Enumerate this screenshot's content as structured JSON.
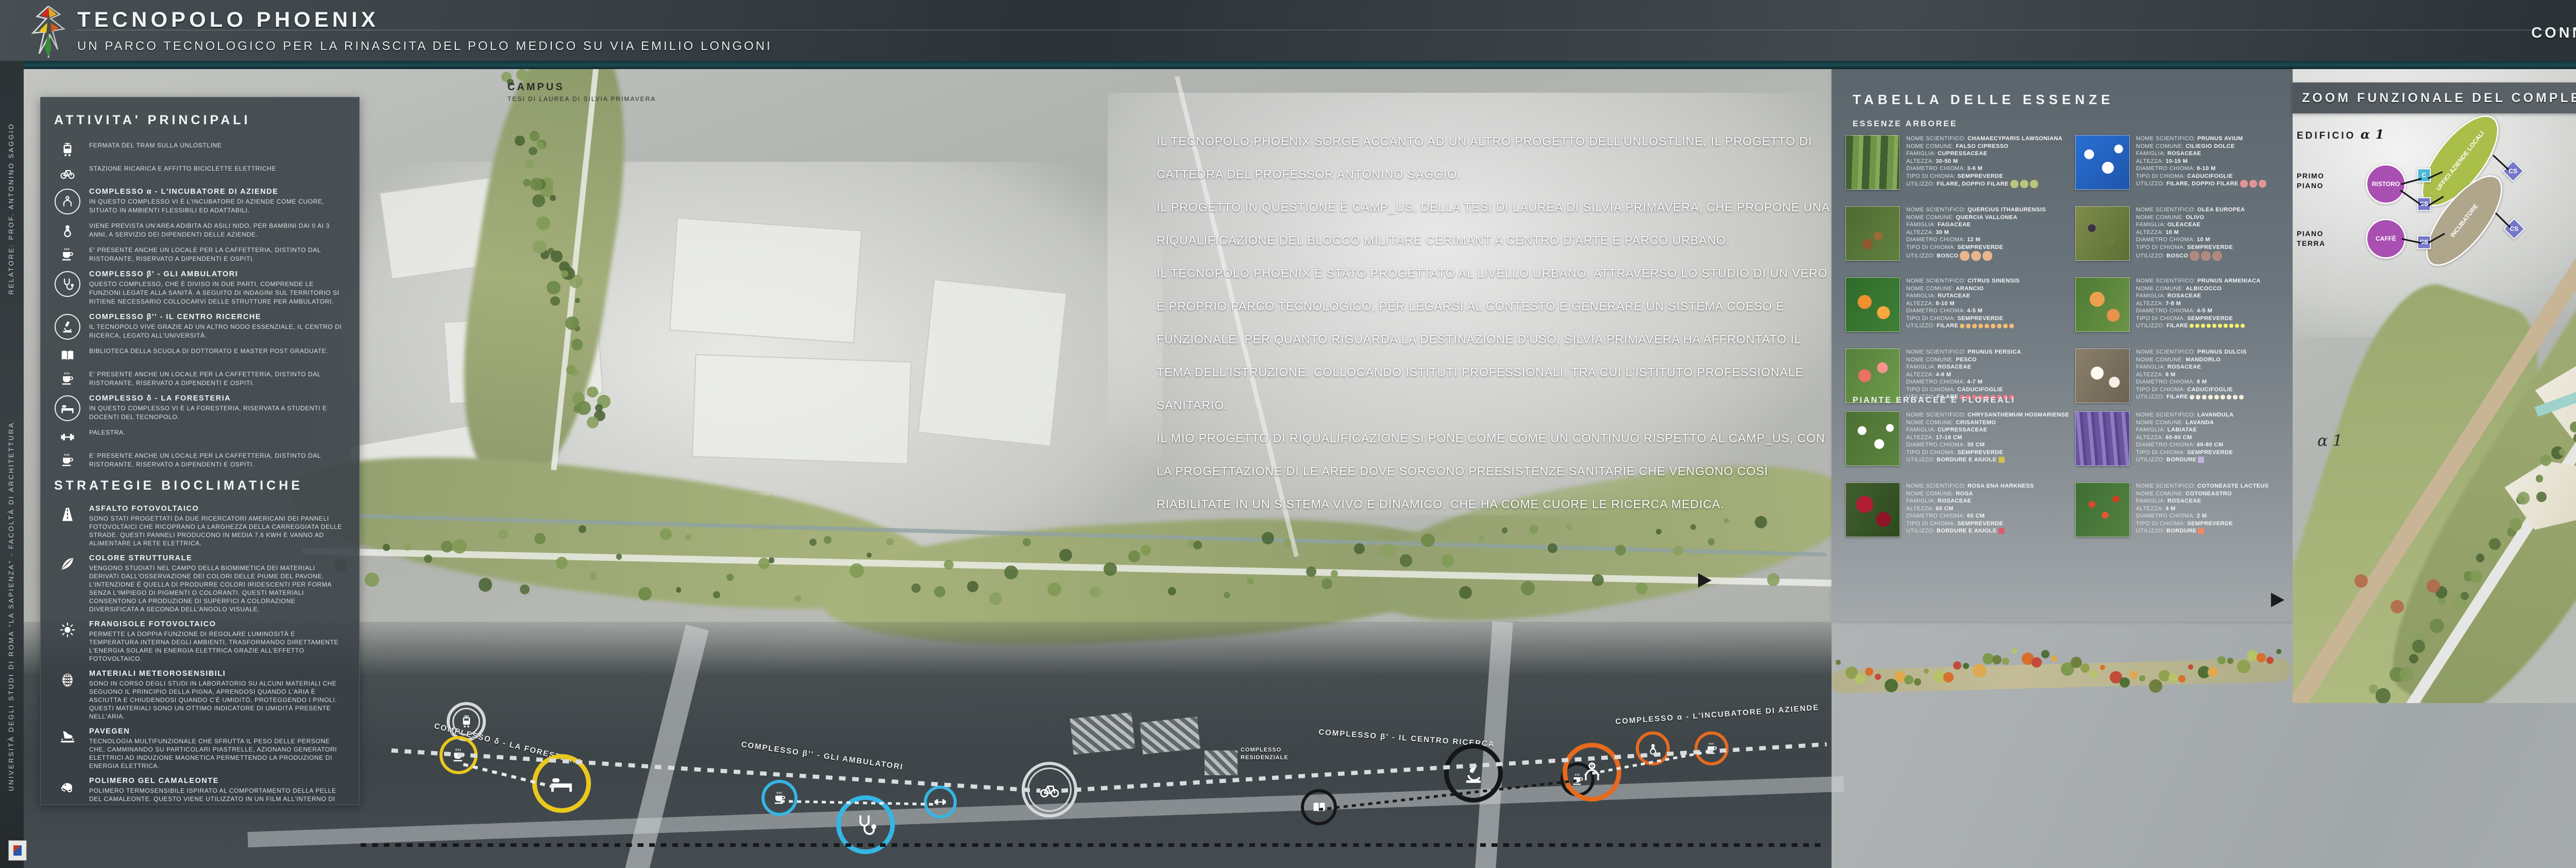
{
  "header": {
    "title": "TECNOPOLO PHOENIX",
    "subtitle": "UN PARCO TECNOLOGICO PER LA RINASCITA DEL POLO MEDICO SU VIA EMILIO LONGONI",
    "right_title": "CONNESSIONE E RIQUALIFICAZIONE: IL PARCO",
    "logo": "phoenix-logo"
  },
  "side_strip": {
    "credit_top": "RELATORE: PROF. ANTONINO SAGGIO",
    "credit_bottom": "UNIVERSITÀ DEGLI STUDI DI ROMA “LA SAPIENZA” - FACOLTÀ DI ARCHITETTURA"
  },
  "map": {
    "campus_label_line1": "CAMPUS",
    "campus_label_line2": "TESI DI LAUREA DI SILVIA PRIMAVERA",
    "intro_paragraphs": [
      "IL TECNOPOLO PHOENIX SORGE ACCANTO AD UN ALTRO PROGETTO DELL'UNLOSTLINE, IL PROGETTO DI CATTEDRA DEL PROFESSOR ANTONINO SAGGIO.",
      "IL PROGETTO IN QUESTIONE È CAMP_US, DELLA TESI DI LAUREA DI SILVIA PRIMAVERA, CHE PROPONE UNA RIQUALIFICAZIONE DEL BLOCCO MILITARE CERIMANT A CENTRO D'ARTE E PARCO URBANO.",
      "IL TECNOPOLO PHOENIX È STATO PROGETTATO AL LIVELLO URBANO, ATTRAVERSO LO STUDIO DI UN VERO E PROPRIO PARCO TECNOLOGICO, PER LEGARSI AL CONTESTO E GENERARE UN SISTEMA COESO E FUNZIONALE. PER QUANTO RIGUARDA LA DESTINAZIONE D'USO, SILVIA PRIMAVERA HA AFFRONTATO IL TEMA DELL'ISTRUZIONE, COLLOCANDO ISTITUTI PROFESSIONALI, TRA CUI L'ISTITUTO PROFESSIONALE SANITARIO.",
      "IL MIO PROGETTO DI RIQUALIFICAZIONE SI PONE COME COME UN CONTINUO RISPETTO AL CAMP_US, CON LA PROGETTAZIONE DI LE AREE DOVE SORGONO PREESISTENZE SANITARIE CHE VENGONO COSÌ RIABILITATE IN UN SISTEMA VIVO E DINAMICO, CHE HA COME CUORE LE RICERCA MEDICA."
    ]
  },
  "sidebar": {
    "title": "ATTIVITA' PRINCIPALI",
    "items": [
      {
        "icon": "tram-icon",
        "circled": false,
        "heading": "",
        "text": "FERMATA DEL TRAM SULLA UNLOSTLINE"
      },
      {
        "icon": "bicycle-icon",
        "circled": false,
        "heading": "",
        "text": "STAZIONE RICARICA E AFFITTO BICICLETTE ELETTRICHE"
      },
      {
        "icon": "incubator-icon",
        "circled": true,
        "heading": "COMPLESSO α - L'INCUBATORE DI AZIENDE",
        "text": "IN QUESTO COMPLESSO VI È L'INCUBATORE DI AZIENDE COME CUORE, SITUATO IN AMBIENTI FLESSIBILI ED ADATTABILI."
      },
      {
        "icon": "pacifier-icon",
        "circled": false,
        "heading": "",
        "text": "VIENE PREVISTA UN'AREA ADIBITA AD ASILI NIDO, PER BAMBINI DAI 0 AI 3 ANNI, A SERVIZIO DEI DIPENDENTI DELLE AZIENDE."
      },
      {
        "icon": "coffee-icon",
        "circled": false,
        "heading": "",
        "text": "E' PRESENTE ANCHE UN LOCALE PER LA CAFFETTERIA, DISTINTO DAL RISTORANTE, RISERVATO A DIPENDENTI E OSPITI."
      },
      {
        "icon": "stethoscope-icon",
        "circled": true,
        "heading": "COMPLESSO β' - GLI AMBULATORI",
        "text": "QUESTO COMPLESSO, CHE È DIVISO IN DUE PARTI, COMPRENDE LE FUNZIONI LEGATE ALLA SANITÀ. A SEGUITO DI INDAGINI SUL TERRITORIO SI RITIENE NECESSARIO COLLOCARVI DELLE STRUTTURE PER AMBULATORI."
      },
      {
        "icon": "microscope-icon",
        "circled": true,
        "heading": "COMPLESSO β'' - IL CENTRO RICERCHE",
        "text": "IL TECNOPOLO VIVE GRAZIE AD UN ALTRO NODO ESSENZIALE, IL CENTRO DI RICERCA, LEGATO ALL'UNIVERSITÀ."
      },
      {
        "icon": "book-icon",
        "circled": false,
        "heading": "",
        "text": "BIBLIOTECA DELLA SCUOLA DI DOTTORATO E MASTER POST GRADUATE."
      },
      {
        "icon": "coffee-icon",
        "circled": false,
        "heading": "",
        "text": "E' PRESENTE ANCHE UN LOCALE PER LA CAFFETTERIA, DISTINTO DAL RISTORANTE, RISERVATO A DIPENDENTI E OSPITI."
      },
      {
        "icon": "bed-icon",
        "circled": true,
        "heading": "COMPLESSO δ - LA FORESTERIA",
        "text": "IN QUESTO COMPLESSO VI È LA FORESTERIA, RISERVATA A STUDENTI E DOCENTI DEL TECNOPOLO."
      },
      {
        "icon": "dumbbell-icon",
        "circled": false,
        "heading": "",
        "text": "PALESTRA."
      },
      {
        "icon": "coffee-icon",
        "circled": false,
        "heading": "",
        "text": "E' PRESENTE ANCHE UN LOCALE PER LA CAFFETTERIA, DISTINTO DAL RISTORANTE, RISERVATO A DIPENDENTI E OSPITI."
      }
    ],
    "strategies_title": "STRATEGIE BIOCLIMATICHE",
    "strategies": [
      {
        "icon": "road-icon",
        "heading": "ASFALTO FOTOVOLTAICO",
        "text": "SONO STATI PROGETTATI DA DUE RICERCATORI AMERICANI DEI PANNELI FOTOVOLTAICI CHE RICOPRANO LA LARGHEZZA DELLA CARREGGIATA DELLE STRADE. QUESTI PANNELI PRODUCONO IN MEDIA 7,6 KWH E VANNO AD ALIMENTARE LA RETE ELETTRICA."
      },
      {
        "icon": "feather-icon",
        "heading": "COLORE STRUTTURALE",
        "text": "VENGONO STUDIATI NEL CAMPO DELLA BIOMIMETICA DEI MATERIALI DERIVATI DALL'OSSERVAZIONE DEI COLORI DELLE PIUME DEL PAVONE. L'INTENZIONE È QUELLA DI PRODURRE COLORI IRIDESCENTI PER FORMA SENZA L'IMPIEGO DI PIGMENTI O COLORANTI. QUESTI MATERIALI CONSENTONO LA PRODUZIONE DI SUPERFICI A COLORAZIONE DIVERSIFICATA A SECONDA DELL'ANGOLO VISUALE."
      },
      {
        "icon": "sun-icon",
        "heading": "FRANGISOLE FOTOVOLTAICO",
        "text": "PERMETTE LA DOPPIA FUNZIONE DI REGOLARE LUMINOSITÀ E TEMPERATURA INTERNA DEGLI AMBIENTI, TRASFORMANDO DIRETTAMENTE L'ENERGIA SOLARE IN ENERGIA ELETTRICA GRAZIE ALL'EFFETTO FOTOVOLTAICO."
      },
      {
        "icon": "pinecone-icon",
        "heading": "MATERIALI METEOROSENSIBILI",
        "text": "SONO IN CORSO DEGLI STUDI IN LABORATORIO SU ALCUNI MATERIALI CHE SEGUONO IL PRINCIPIO DELLA PIGNA, APRENDOSI QUANDO L'ARIA È ASCIUTTA E CHIUDENDOSI QUANDO C'È UMIDITÒ, PROTEGGENDO I PINOLI. QUESTI MATERIALI SONO UN OTTIMO INDICATORE DI UMIDITÀ PRESENTE NELL'ARIA."
      },
      {
        "icon": "footstep-icon",
        "heading": "PAVEGEN",
        "text": "TECNOLOGIA MULTIFUNZIONALE CHE SFRUTTA IL PESO DELLE PERSONE CHE, CAMMINANDO SU PARTICOLARI PIASTRELLE, AZIONANO GENERATORI ELETTRICI AD INDUZIONE MAGNETICA PERMETTENDO LA PRODUZIONE DI ENERGIA ELETTRICA."
      },
      {
        "icon": "chameleon-icon",
        "heading": "POLIMERO GEL CAMALEONTE",
        "text": "POLIMERO TERMOSENSIBILE ISPIRATO AL COMPORTAMENTO DELLA PELLE DEL CAMALEONTE. QUESTO VIENE UTILIZZATO IN UN FILM ALL'INTERNO DI PANNELLI VETRATI E CAMBIA COLORE IN BASE AL SOLE, DIVENTANDO UN OTTIMO SCHERMO SOLARE. SI ARRIVA AD AVERE SCHERMI MIMETICI."
      }
    ]
  },
  "essences": {
    "title": "TABELLA DELLE ESSENZE",
    "group1": "ESSENZE ARBOREE",
    "group2": "PIANTE ERBACEE E FLOREALI",
    "labels": {
      "sci": "NOME SCIENTIFICO: ",
      "com": "NOME COMUNE: ",
      "fam": "FAMIGLIA: ",
      "alt": "ALTEZZA: ",
      "dia": "DIAMETRO CHIOMA: ",
      "tipo": "TIPO DI CHIOMA: ",
      "uti": "UTILIZZO: "
    },
    "arboree": [
      {
        "sci": "CHAMAECYPARIS LAWSONIANA",
        "com": "FALSO CIPRESSO",
        "fam": "CUPRESSACEAE",
        "alt": "30-50 M",
        "dia": "3-6 M",
        "tipo": "SEMPREVERDE",
        "uti": "FILARE, DOPPIO FILARE",
        "dots": {
          "shape": "circle",
          "color": "#b9c47c",
          "count": 3,
          "size": 16
        }
      },
      {
        "sci": "PRUNUS AVIUM",
        "com": "CILIEGIO DOLCE",
        "fam": "ROSACEAE",
        "alt": "10-15 M",
        "dia": "8-10 M",
        "tipo": "CADUCIFOGLIE",
        "uti": "FILARE, DOPPIO FILARE",
        "dots": {
          "shape": "circle",
          "color": "#e29597",
          "count": 3,
          "size": 15
        }
      },
      {
        "sci": "QUERCIUS ITHABURENSIS",
        "com": "QUERCIA VALLONEA",
        "fam": "FAGACEAE",
        "alt": "30 M",
        "dia": "12 M",
        "tipo": "SEMPREVERDE",
        "uti": "BOSCO",
        "dots": {
          "shape": "circle",
          "color": "#e8b58d",
          "count": 3,
          "size": 19
        }
      },
      {
        "sci": "OLEA EUROPEA",
        "com": "OLIVO",
        "fam": "OLEACEAE",
        "alt": "10 M",
        "dia": "10 M",
        "tipo": "SEMPREVERDE",
        "uti": "BOSCO",
        "dots": {
          "shape": "circle",
          "color": "#b08a7e",
          "count": 3,
          "size": 19
        }
      },
      {
        "sci": "CITRUS SINENSIS",
        "com": "ARANCIO",
        "fam": "RUTACEAE",
        "alt": "8-10 M",
        "dia": "4-5 M",
        "tipo": "SEMPREVERDE",
        "uti": "FILARE",
        "dots": {
          "shape": "circle",
          "color": "#f2bc72",
          "count": 9,
          "size": 9
        }
      },
      {
        "sci": "PRUNUS ARMENIACA",
        "com": "ALBICOCCO",
        "fam": "ROSACEAE",
        "alt": "7-8 M",
        "dia": "4-5 M",
        "tipo": "SEMPREVERDE",
        "uti": "FILARE",
        "dots": {
          "shape": "circle",
          "color": "#f4f06a",
          "count": 10,
          "size": 8
        }
      },
      {
        "sci": "PRUNUS PERSICA",
        "com": "PESCO",
        "fam": "ROSACEAE",
        "alt": "4-8 M",
        "dia": "4-7 M",
        "tipo": "CADUCIFOGLIE",
        "uti": "FILARE",
        "dots": {
          "shape": "circle",
          "color": "#f27a86",
          "count": 9,
          "size": 9
        }
      },
      {
        "sci": "PRUNUS DULCIS",
        "com": "MANDORLO",
        "fam": "ROSACEAE",
        "alt": "8 M",
        "dia": "8 M",
        "tipo": "CADUCIFOGLIE",
        "uti": "FILARE",
        "dots": {
          "shape": "circle",
          "color": "#f2ecd8",
          "count": 9,
          "size": 9
        }
      }
    ],
    "erbacee": [
      {
        "sci": "CHRYSANTHEMUM HOSMARIENSE",
        "com": "CRISANTEMO",
        "fam": "CUPRESSACEAE",
        "alt": "17-18 CM",
        "dia": "30 CM",
        "tipo": "SEMPREVERDE",
        "uti": "BORDURE E AIUOLE",
        "dots": {
          "shape": "square",
          "color": "#cfc14e",
          "count": 1,
          "size": 12
        }
      },
      {
        "sci": "LAVANDULA",
        "com": "LAVANDA",
        "fam": "LABIATAE",
        "alt": "60-80 CM",
        "dia": "60-80 CM",
        "tipo": "SEMPREVERDE",
        "uti": "BORDURE",
        "dots": {
          "shape": "square",
          "color": "#c3b4dc",
          "count": 1,
          "size": 12
        }
      },
      {
        "sci": "ROSA ENA HARKNESS",
        "com": "ROSA",
        "fam": "ROSACEAE",
        "alt": "60 CM",
        "dia": "60 CM",
        "tipo": "SEMPREVERDE",
        "uti": "BORDURE E AIUOLE",
        "dots": {
          "shape": "square",
          "color": "#d95f70",
          "count": 1,
          "size": 12
        }
      },
      {
        "sci": "COTONEASTE LACTEUS",
        "com": "COTONEASTRO",
        "fam": "ROSACEAE",
        "alt": "4 M",
        "dia": "2 M",
        "tipo": "SEMPREVERDE",
        "uti": "BORDURE",
        "dots": {
          "shape": "square",
          "color": "#f08a60",
          "count": 1,
          "size": 12
        }
      }
    ]
  },
  "right": {
    "banner": "ZOOM FUNZIONALE DEL COMPLESSO α - L'INCUBATORE DI AZIENDE",
    "floors": [
      "PRIMO PIANO",
      "PIANO TERRA"
    ],
    "edifici_titles": [
      "EDIFICIO",
      "EDIFICIO",
      "EDIFICIO"
    ],
    "edifici_alphas": [
      "α 1",
      "α 2",
      "α 3"
    ],
    "node_labels": {
      "ristoro": "RISTORO",
      "caffe": "CAFFÈ",
      "uffici_az": "UFFICI AZIENDE LOCALI",
      "uffici_aff": "UFFICI AFFITTO",
      "incubatore": "INCUBATORE",
      "biblioteca": "BIBLIOTECA",
      "archivio": "ARCHIVIO",
      "parco": "PARCO",
      "c": "C",
      "cs": "CS"
    },
    "plan_label_a1": "α 1",
    "plan_label_a3": "α 3",
    "text_paragraphs": [
      "IL PROGETTO DEL TECNOPOLO PHOENIX NASCE DALLA PICCOLA SCALA ANDANDO A CONSIDERARE LE AREE CHE SI AFFACCIANO SU VIA EMILIO LONGONI, PER UNA LUNGHEZZA DI QUASI TRE CHILOMETRI.",
      "LA PROGETTAZIONE VIENE AFFRONTATA PIÙ DA VICINO PER ANALIZZARE I RAPPORTI CHE SI GENERANO TRA GLI EDIFICI DELL'INCUBATORE DI AZIENDE, CORRISPONDENTE AL COMPLESSO α, ANDANDO A STUDIARE LA DISTRIBUZIONE FUNZIONALE, ANCHE IN RELAZIONE AL PROGRAMMA."
    ]
  },
  "bottom": {
    "clusters": [
      {
        "label": "COMPLESSO δ - LA FORESTERIA",
        "color": "#e9c81e",
        "icons": [
          "coffee-icon",
          "bed-icon"
        ]
      },
      {
        "label": "COMPLESSO β'' - GLI AMBULATORI",
        "color": "#35b6e4",
        "icons": [
          "coffee-icon",
          "stethoscope-icon",
          "dumbbell-icon"
        ]
      },
      {
        "label": "COMPLESSO β' - IL CENTRO RICERCA",
        "color": "#151617",
        "icons": [
          "book-icon",
          "microscope-icon",
          "coffee-icon"
        ]
      },
      {
        "label": "COMPLESSO α - L'INCUBATORE DI AZIENDE",
        "color": "#e76a1e",
        "icons": [
          "incubator-icon",
          "pacifier-icon",
          "coffee-icon"
        ]
      }
    ],
    "residential_label": "COMPLESSO RESIDENZIALE",
    "stations": [
      "tram-icon",
      "bicycle-icon"
    ]
  },
  "colors": {
    "accent_purple": "#a94fb2",
    "accent_olive": "#aabf4a",
    "accent_dark_olive": "#7e8c22",
    "accent_taupe": "#b0a68c",
    "accent_tan": "#c2a183",
    "accent_brown": "#8a5240",
    "accent_green": "#52bd8e",
    "square_cs": "#7577c9",
    "square_c": "#4fb7d8"
  }
}
